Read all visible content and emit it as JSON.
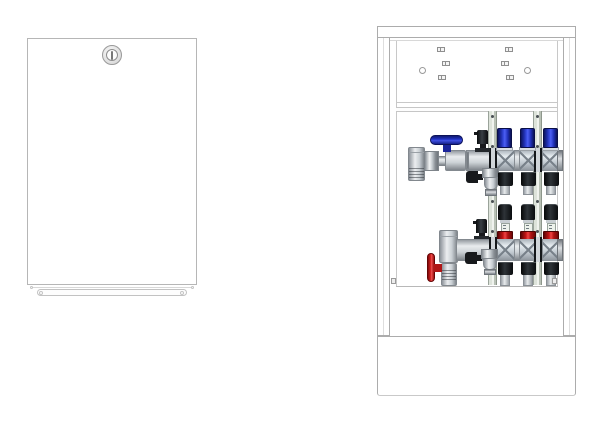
{
  "page": {
    "background": "#ffffff",
    "description": "Technical product illustration: underfloor-heating manifold cabinet shown closed (left) and open with a 3-circuit manifold (right)"
  },
  "colors": {
    "background": "#ffffff",
    "outline": "#acacac",
    "metal-hi": "#eceef0",
    "metal-lo": "#7f858b",
    "blue": "#2f3fd6",
    "blue-dark": "#0d1560",
    "red": "#d82020",
    "red-dark": "#5e0505",
    "black-part": "#17191c",
    "rail-tint": "#dde3da"
  },
  "left_figure": {
    "title": "Manifold cabinet, door closed",
    "parts": [
      "door-panel",
      "cylinder-lock",
      "bottom-kick-bar"
    ]
  },
  "right_figure": {
    "title": "Manifold cabinet, open, with heating circuit manifold",
    "circuits": 3,
    "frame_parts": [
      "top-rail",
      "left-post",
      "right-post",
      "back-panel-with-slots",
      "mounting-rail-bar",
      "plinth"
    ],
    "supply_manifold": {
      "cap_color": "blue",
      "parts": [
        "end-union",
        "ball-valve-blue-handle",
        "air-vent",
        "drain-valve",
        "manifold-body",
        "actuator-caps",
        "loop-connection-nuts"
      ]
    },
    "return_manifold": {
      "collar_color": "red",
      "parts": [
        "elbow-union",
        "shut-off-valve-red-handle",
        "air-vent",
        "drain-valve",
        "manifold-body",
        "flow-meters",
        "lockshield-collars",
        "loop-connection-nuts"
      ]
    },
    "mounting_brackets": 2,
    "flow_meters": 3,
    "actuator_caps": 3
  }
}
